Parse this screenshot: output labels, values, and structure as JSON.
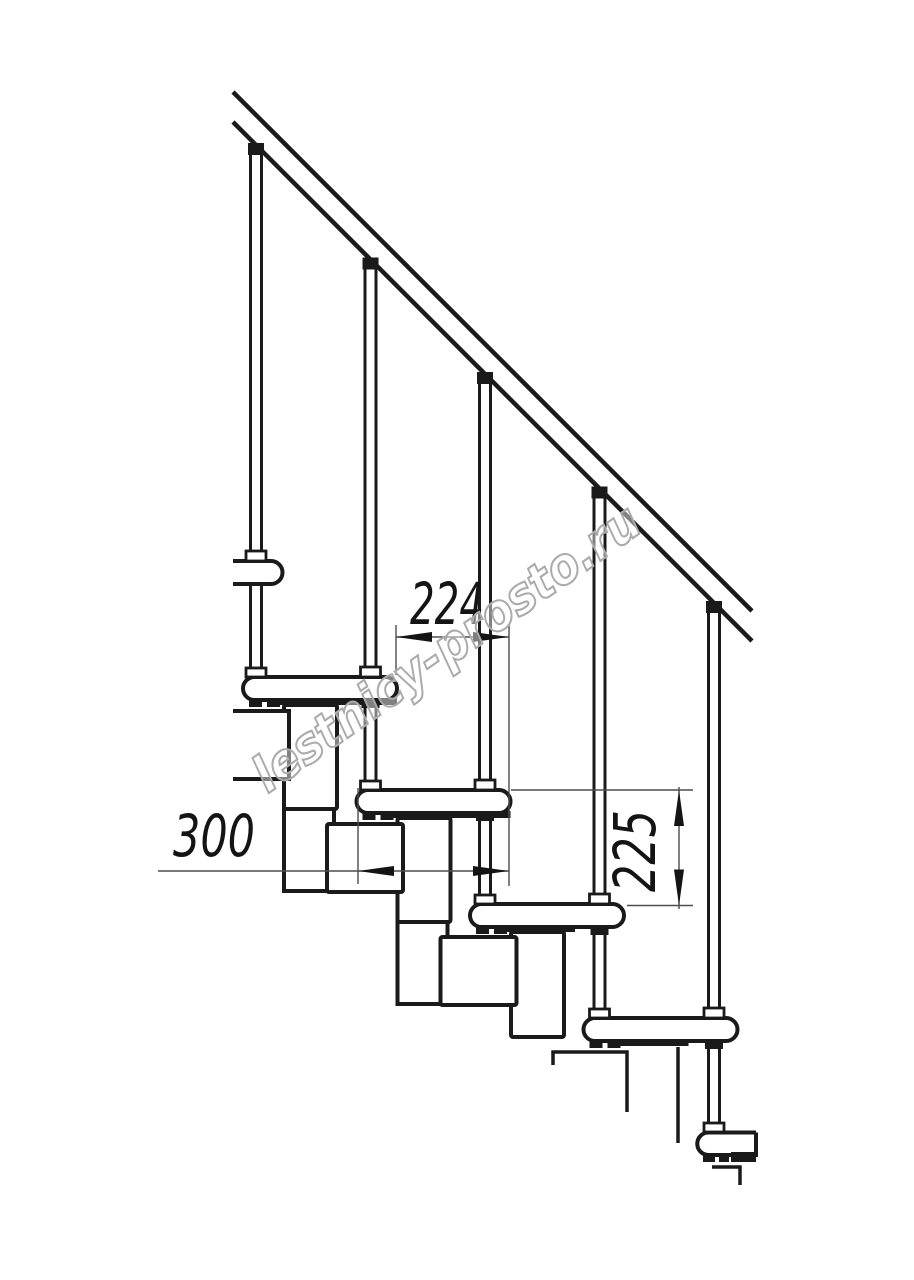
{
  "page": {
    "background_color": "#ffffff",
    "description": "Technical side-view drawing of a modular staircase with handrail, balusters and treads"
  },
  "drawing": {
    "line_color": "#1a1a1a",
    "dim_line_color": "#4d4d4d",
    "dimensions": {
      "step_run": "224",
      "tread_depth": "300",
      "step_rise": "225"
    },
    "components": {
      "handrail": "handrail",
      "balusters": 5,
      "treads": 6,
      "support_modules": "stacked modules under treads"
    }
  },
  "watermark": {
    "text": "lestnicy-prosto.ru",
    "color": "#ababab"
  }
}
